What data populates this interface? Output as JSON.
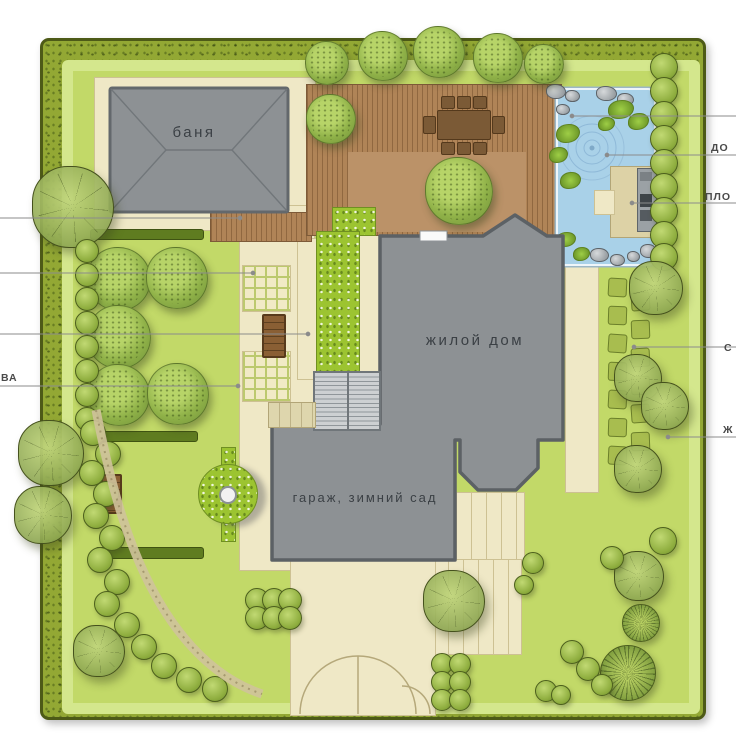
{
  "plan": {
    "buildings": {
      "banya": "баня",
      "house": "жилой дом",
      "garage": "гараж, зимний сад"
    },
    "callouts": {
      "left_bottom": "ВА",
      "right_1": "ДО",
      "right_2": "ПЛО",
      "right_3": "С",
      "right_4": "Ж"
    },
    "features": {
      "pond": "decorative-pond",
      "terrace": "wooden-deck-terrace",
      "dining_set": "table-with-8-chairs",
      "orchard": "fruit-trees",
      "gates": "double-gate-and-wicket"
    },
    "colors": {
      "lawn": "#c2d968",
      "hedge": "#93a834",
      "building": "#8d9194",
      "deck": "#b08457",
      "water": "#a9d1e8",
      "path": "#efe8c6"
    }
  }
}
